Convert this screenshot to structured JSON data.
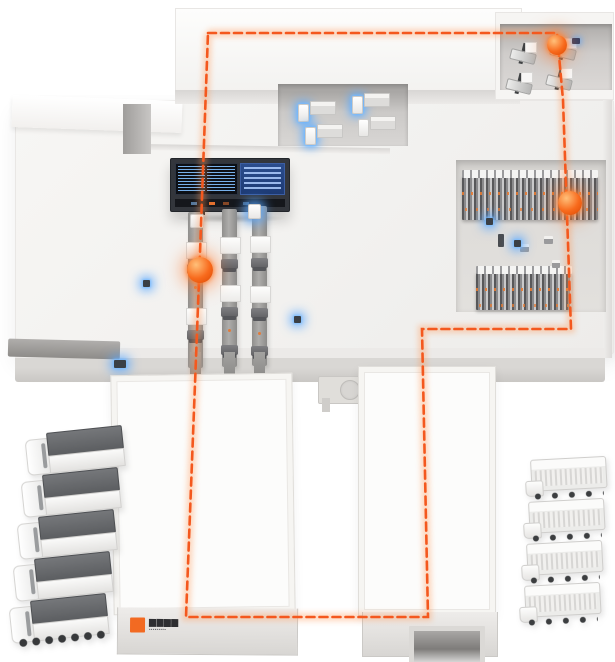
{
  "scene": {
    "name": "smart-warehouse-logistics-illustration",
    "background": "#ffffff",
    "accent_orange": "#f4581e",
    "glow_blue": "#5fb0ff",
    "route": {
      "style": "dashed-loop",
      "color": "#f4581e",
      "points": "208,33 557,33 563,100 571,329 422,329 428,617 186,617 199,280 208,33"
    },
    "markers": [
      {
        "name": "northeast-dock-marker",
        "x": 557,
        "y": 45
      },
      {
        "name": "racking-marker",
        "x": 570,
        "y": 203
      },
      {
        "name": "conveyor-marker",
        "x": 200,
        "y": 270
      }
    ]
  },
  "building": {
    "logo": {
      "line1": "▆▆▆▆",
      "line2": "▪▪▪▪▪▪▪▪▪",
      "badge_color": "#f26a22"
    }
  },
  "equipment": {
    "control_dashboard_screens": 1,
    "conveyor_lines": 3,
    "workstations": 4,
    "dock_vehicles": 4,
    "rack_rows": 2,
    "iot_sensor_glows": 6
  },
  "fleet": {
    "left_trucks": 5,
    "right_trucks": 4
  }
}
